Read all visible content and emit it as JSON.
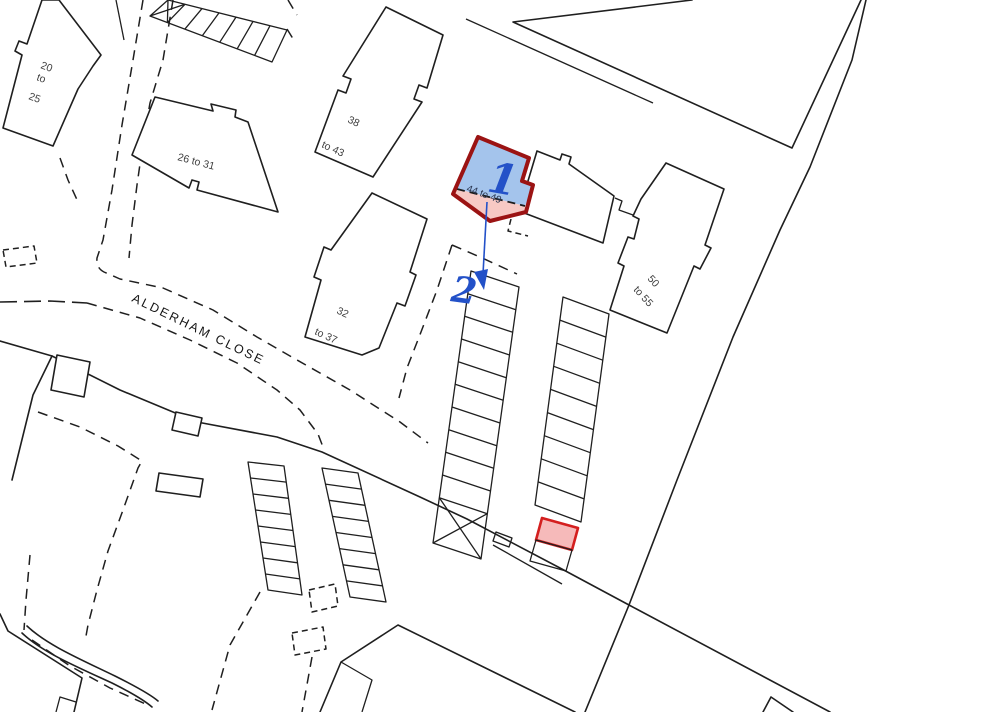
{
  "map": {
    "street_label": "ALDERHAM CLOSE",
    "markers": {
      "plot1": "1",
      "plot2": "2",
      "plot1_range": "44 to 49"
    },
    "building_labels": {
      "b20_25": [
        "20",
        "to",
        "25"
      ],
      "b26_31": "26 to 31",
      "b38_43": [
        "38",
        "to 43"
      ],
      "b32_37": [
        "32",
        "to 37"
      ],
      "b50_55": [
        "50",
        "to 55"
      ]
    },
    "colors": {
      "line": "#1f1f1f",
      "label": "#3f3f3f",
      "plot_outline": "#9b1313",
      "plot_fill_blue": "#a4c4ec",
      "plot_fill_pink": "#f7c9c4",
      "bay_outline": "#d41f1f",
      "bay_fill": "#f6baba",
      "marker_blue": "#2351c8"
    }
  }
}
